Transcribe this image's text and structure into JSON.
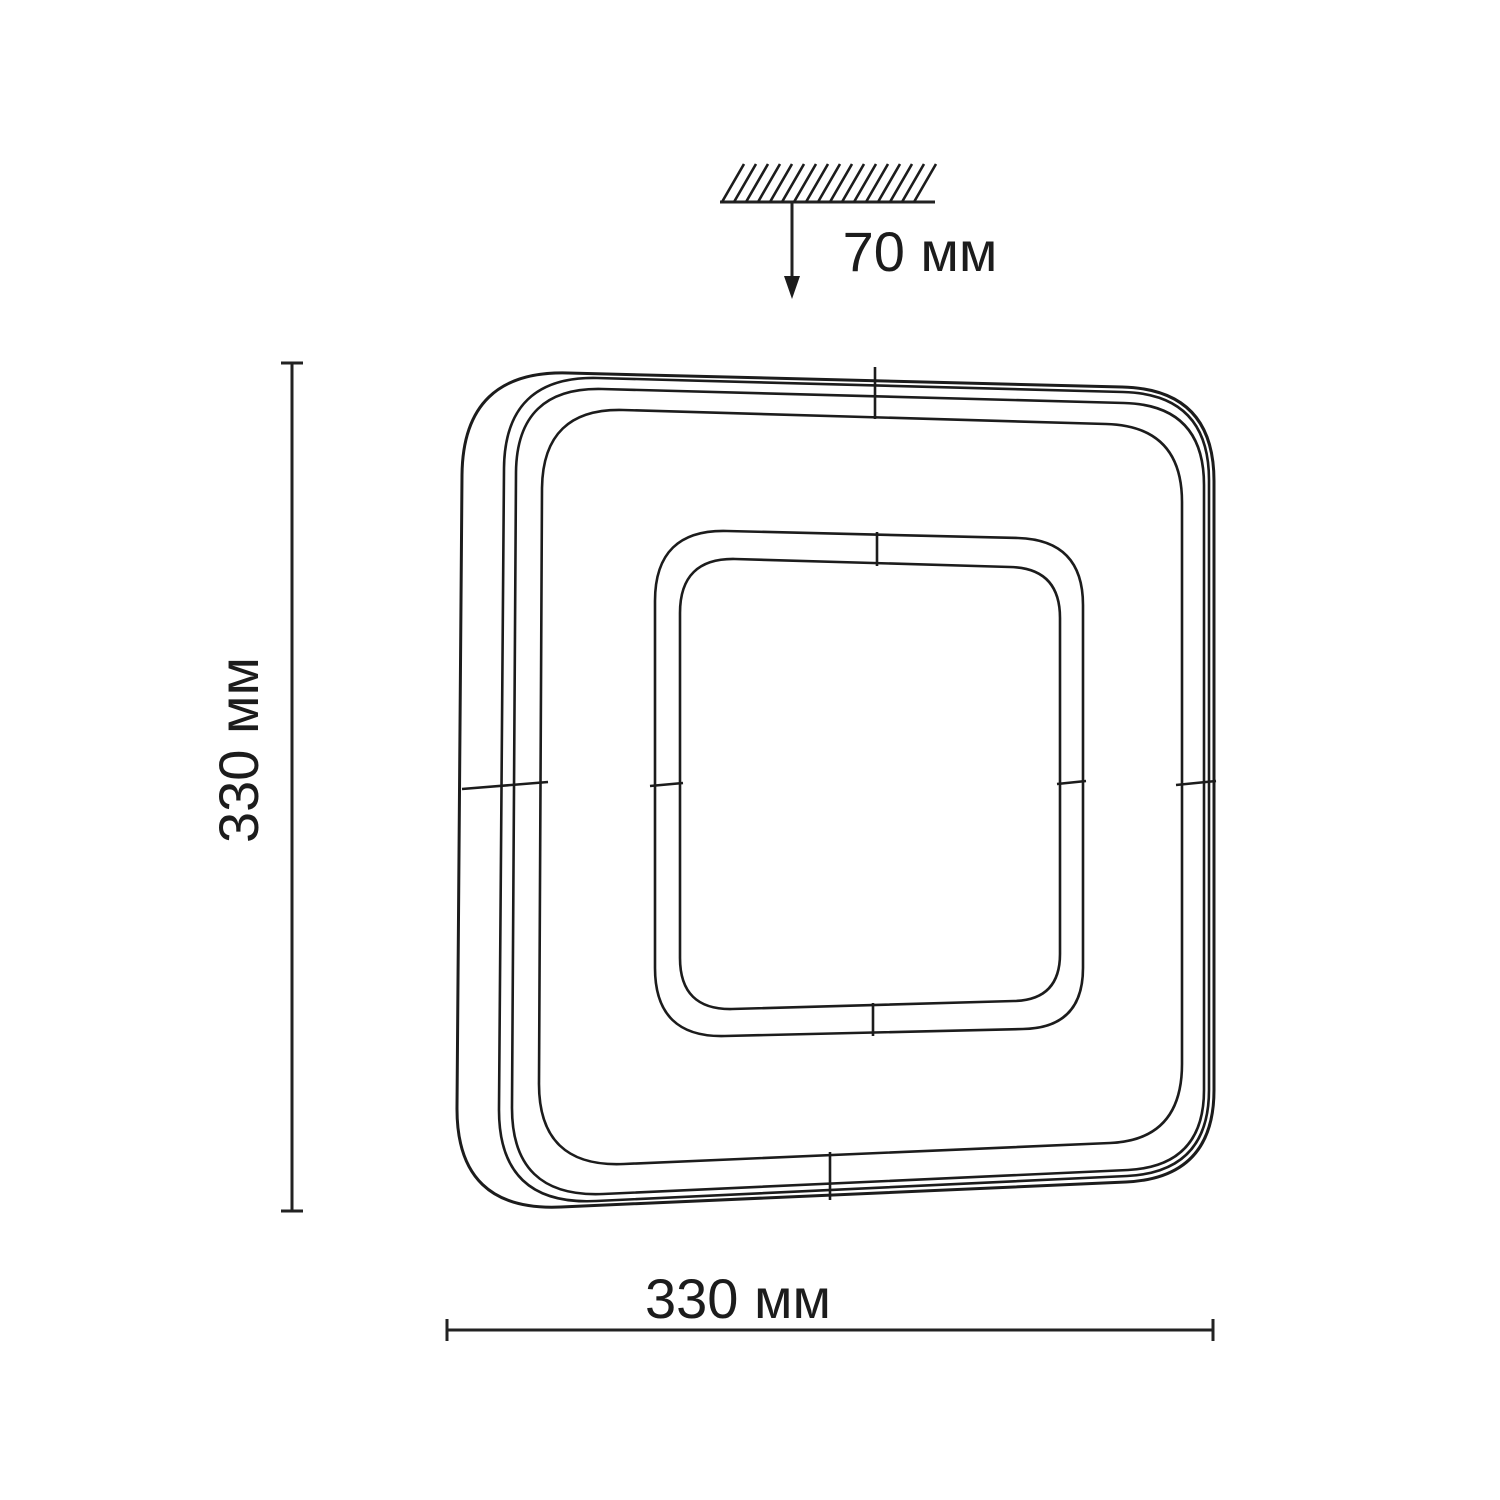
{
  "drawing": {
    "background": "#ffffff",
    "line_color": "#1c1c1c",
    "labels": {
      "ceiling_offset": "70 мм",
      "height": "330 мм",
      "width": "330 мм"
    }
  }
}
